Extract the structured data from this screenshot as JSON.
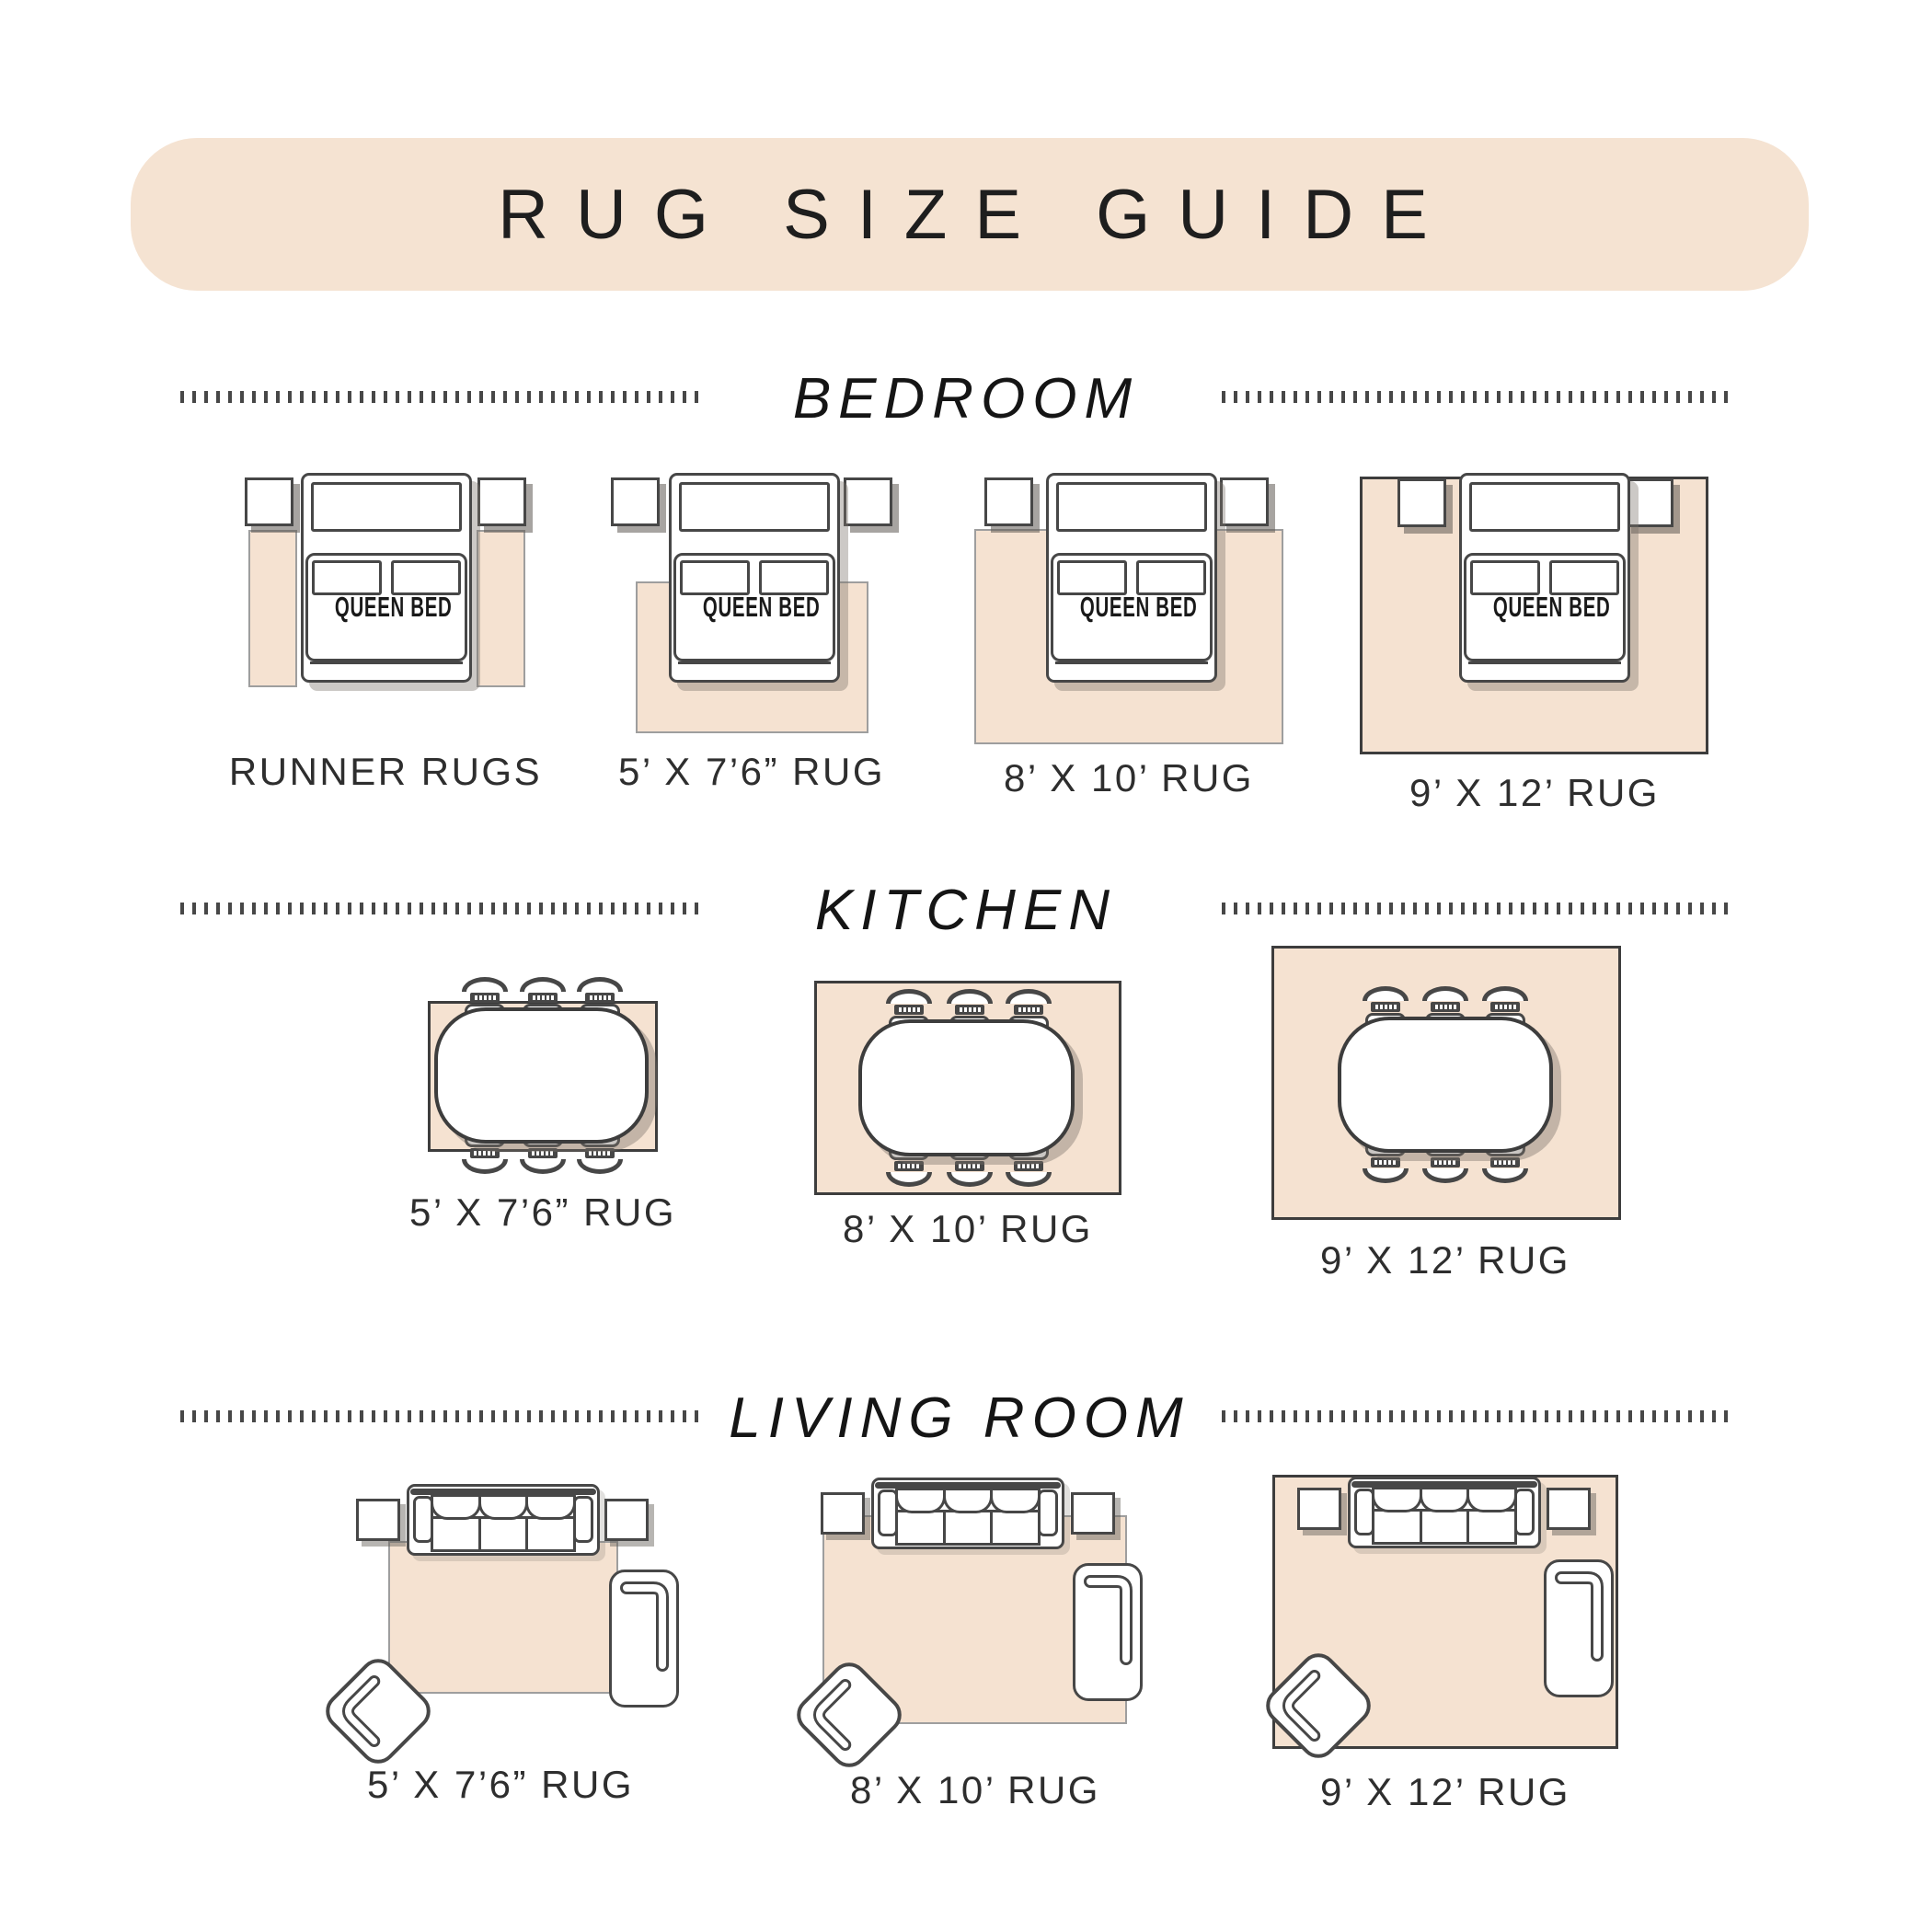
{
  "header": {
    "title": "RUG SIZE GUIDE"
  },
  "sections": [
    {
      "id": "bedroom",
      "title": "BEDROOM",
      "bed_label": "QUEEN BED",
      "items": [
        {
          "label": "RUNNER RUGS"
        },
        {
          "label": "5’ X 7’6” RUG"
        },
        {
          "label": "8’ X 10’ RUG"
        },
        {
          "label": "9’ X 12’ RUG"
        }
      ]
    },
    {
      "id": "kitchen",
      "title": "KITCHEN",
      "items": [
        {
          "label": "5’ X 7’6” RUG"
        },
        {
          "label": "8’ X 10’ RUG"
        },
        {
          "label": "9’ X 12’ RUG"
        }
      ]
    },
    {
      "id": "living_room",
      "title": "LIVING ROOM",
      "items": [
        {
          "label": "5’ X 7’6” RUG"
        },
        {
          "label": "8’ X 10’ RUG"
        },
        {
          "label": "9’ X 12’ RUG"
        }
      ]
    }
  ],
  "colors": {
    "banner_bg": "#f5e3d2",
    "rug_fill": "#f5e2d1",
    "outline": "#474747",
    "rug_border_light": "#9e9e9e",
    "rug_border_dark": "#3d3d3d",
    "label": "#2e2e2e"
  }
}
